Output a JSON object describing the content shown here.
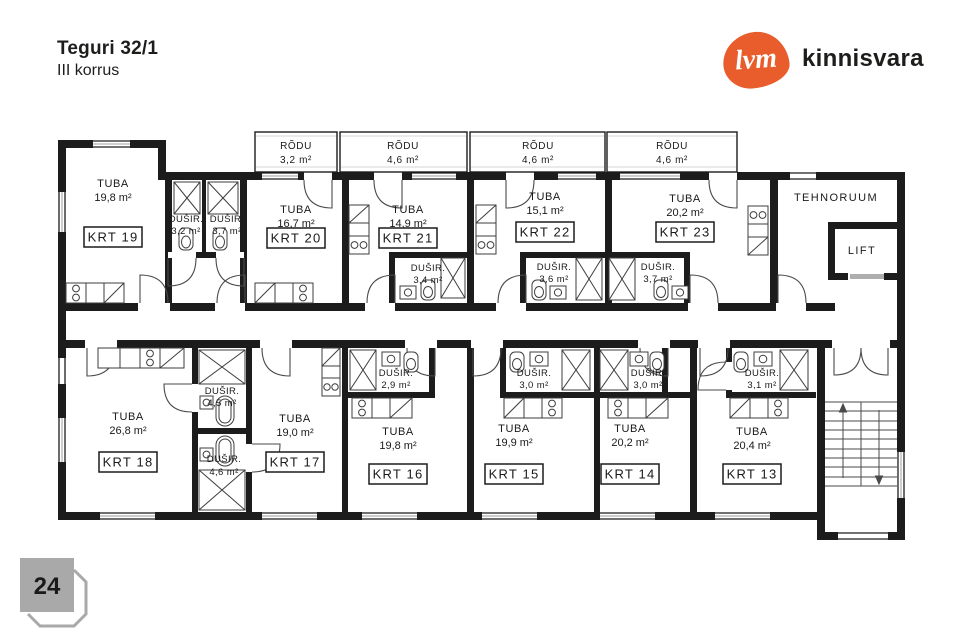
{
  "header": {
    "title": "Teguri 32/1",
    "subtitle": "III korrus"
  },
  "logo": {
    "mark": "lvm",
    "brand": "kinnisvara",
    "color": "#e95c2b"
  },
  "footer": {
    "page_number": "24"
  },
  "plan": {
    "service_rooms": {
      "tehnoruum": "TEHNORUUM",
      "lift": "LIFT"
    },
    "balconies": [
      {
        "label": "RÕDU",
        "area": "3,2 m²"
      },
      {
        "label": "RÕDU",
        "area": "4,6 m²"
      },
      {
        "label": "RÕDU",
        "area": "4,6 m²"
      },
      {
        "label": "RÕDU",
        "area": "4,6 m²"
      }
    ],
    "apartments_top": [
      {
        "id": "KRT 19",
        "room": "TUBA",
        "area": "19,8 m²",
        "shower_label": "DUŠIR.",
        "shower_area": "3,2 m²"
      },
      {
        "id": "KRT 20",
        "room": "TUBA",
        "area": "16,7 m²",
        "shower_label": "DUŠIR.",
        "shower_area": "3,7 m²"
      },
      {
        "id": "KRT 21",
        "room": "TUBA",
        "area": "14,9 m²",
        "shower_label": "DUŠIR.",
        "shower_area": "3,4 m²"
      },
      {
        "id": "KRT 22",
        "room": "TUBA",
        "area": "15,1 m²",
        "shower_label": "DUŠIR.",
        "shower_area": "3,6 m²"
      },
      {
        "id": "KRT 23",
        "room": "TUBA",
        "area": "20,2 m²",
        "shower_label": "DUŠIR.",
        "shower_area": "3,7 m²"
      }
    ],
    "apartments_bottom": [
      {
        "id": "KRT 18",
        "room": "TUBA",
        "area": "26,8 m²",
        "shower_label": "DUŠIR.",
        "shower_area": "4,5 m²"
      },
      {
        "id": "KRT 17",
        "room": "TUBA",
        "area": "19,0 m²",
        "shower_label": "DUŠIR.",
        "shower_area": "4,6 m²"
      },
      {
        "id": "KRT 16",
        "room": "TUBA",
        "area": "19,8 m²",
        "shower_label": "DUŠIR.",
        "shower_area": "2,9 m²"
      },
      {
        "id": "KRT 15",
        "room": "TUBA",
        "area": "19,9 m²",
        "shower_label": "DUŠIR.",
        "shower_area": "3,0 m²"
      },
      {
        "id": "KRT 14",
        "room": "TUBA",
        "area": "20,2 m²",
        "shower_label": "DUŠIR.",
        "shower_area": "3,0 m²"
      },
      {
        "id": "KRT 13",
        "room": "TUBA",
        "area": "20,4 m²",
        "shower_label": "DUŠIR.",
        "shower_area": "3,1 m²"
      }
    ]
  }
}
